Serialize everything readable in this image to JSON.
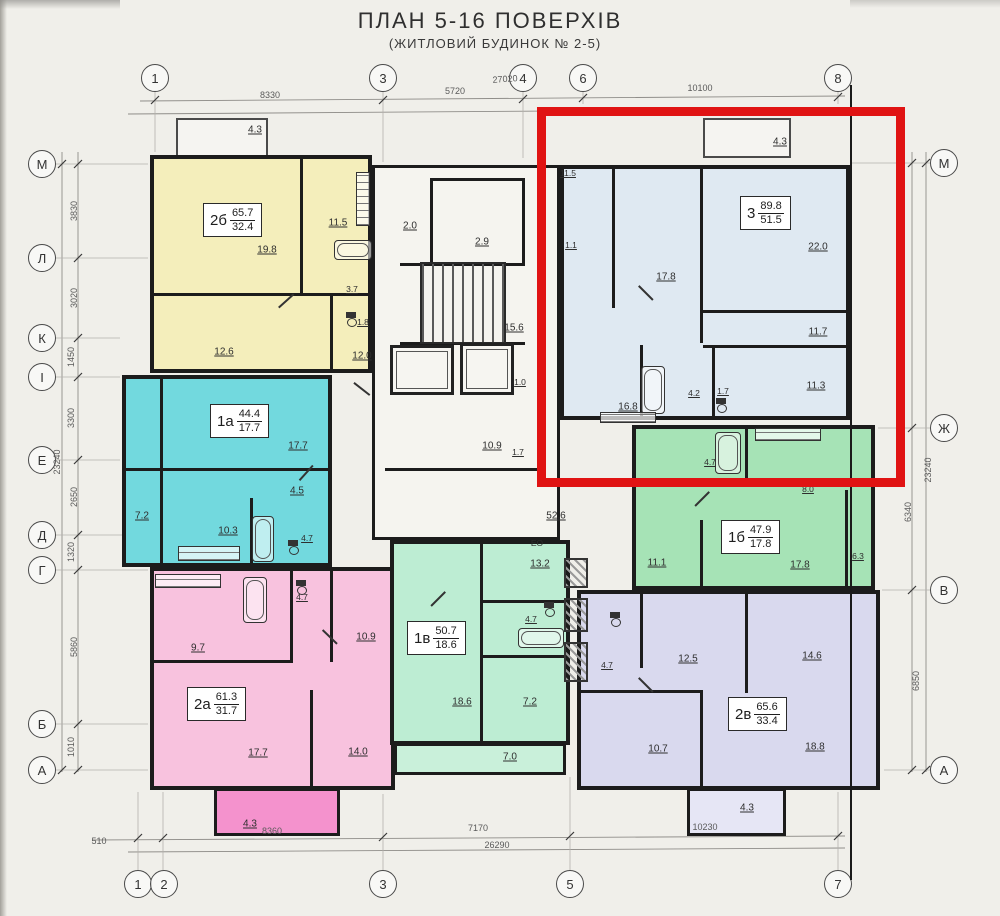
{
  "title": {
    "main": "ПЛАН 5-16 ПОВЕРХІВ",
    "sub": "(ЖИТЛОВИЙ БУДИНОК № 2-5)"
  },
  "highlight": {
    "color": "#e01313"
  },
  "axes": {
    "top": [
      "1",
      "3",
      "4",
      "6",
      "8"
    ],
    "bottom": [
      "1",
      "2",
      "3",
      "5",
      "7"
    ],
    "left": [
      "М",
      "Л",
      "К",
      "І",
      "Е",
      "Д",
      "Г",
      "Б",
      "А"
    ],
    "right": [
      "М",
      "Ж",
      "В",
      "А"
    ]
  },
  "dims": {
    "top": [
      "8330",
      "5720",
      "27020",
      "10100"
    ],
    "bottom": [
      "510",
      "8360",
      "7170",
      "26290",
      "10230"
    ],
    "left": [
      "3830",
      "3020",
      "1450",
      "3300",
      "2650",
      "1320",
      "5860",
      "1010",
      "23240"
    ],
    "right": [
      "6340",
      "6850",
      "23240"
    ]
  },
  "apartments": [
    {
      "code": "2б",
      "total": "65.7",
      "living": "32.4",
      "color": "#f4eebb",
      "rooms": [
        "19.8",
        "11.5",
        "3.7",
        "1.8",
        "12.6",
        "12.0"
      ],
      "balcony": "4.3"
    },
    {
      "code": "1а",
      "total": "44.4",
      "living": "17.7",
      "color": "#72d9de",
      "rooms": [
        "17.7",
        "4.5",
        "7.2",
        "10.3",
        "4.7"
      ]
    },
    {
      "code": "2а",
      "total": "61.3",
      "living": "31.7",
      "color": "#f8c2de",
      "rooms": [
        "9.7",
        "4.7",
        "10.9",
        "17.7",
        "14.0"
      ],
      "balcony": "4.3",
      "balcony_color": "#f492cd"
    },
    {
      "code": "1в",
      "total": "50.7",
      "living": "18.6",
      "color": "#bdedd3",
      "rooms": [
        "13.2",
        "4.7",
        "18.6",
        "7.2"
      ],
      "balcony": "7.0",
      "balcony_color": "#c9f0da",
      "extra": "ЕО"
    },
    {
      "code": "3",
      "total": "89.8",
      "living": "51.5",
      "color": "#dfe9f2",
      "rooms": [
        "11.5",
        "1.1",
        "17.8",
        "22.0",
        "11.7",
        "11.3",
        "16.8",
        "4.2",
        "1.7"
      ],
      "balcony": "4.3"
    },
    {
      "code": "1б",
      "total": "47.9",
      "living": "17.8",
      "color": "#a6e3b6",
      "rooms": [
        "4.7",
        "8.0",
        "11.1",
        "17.8",
        "6.3"
      ]
    },
    {
      "code": "2в",
      "total": "65.6",
      "living": "33.4",
      "color": "#d9d9ee",
      "rooms": [
        "4.7",
        "12.5",
        "14.6",
        "10.7",
        "18.8"
      ],
      "balcony": "4.3",
      "balcony_color": "#e6e6f5"
    }
  ],
  "core": {
    "labels": [
      "2.0",
      "2.9",
      "15.6",
      "10.9",
      "1.7",
      "1.0",
      "52.6"
    ]
  }
}
